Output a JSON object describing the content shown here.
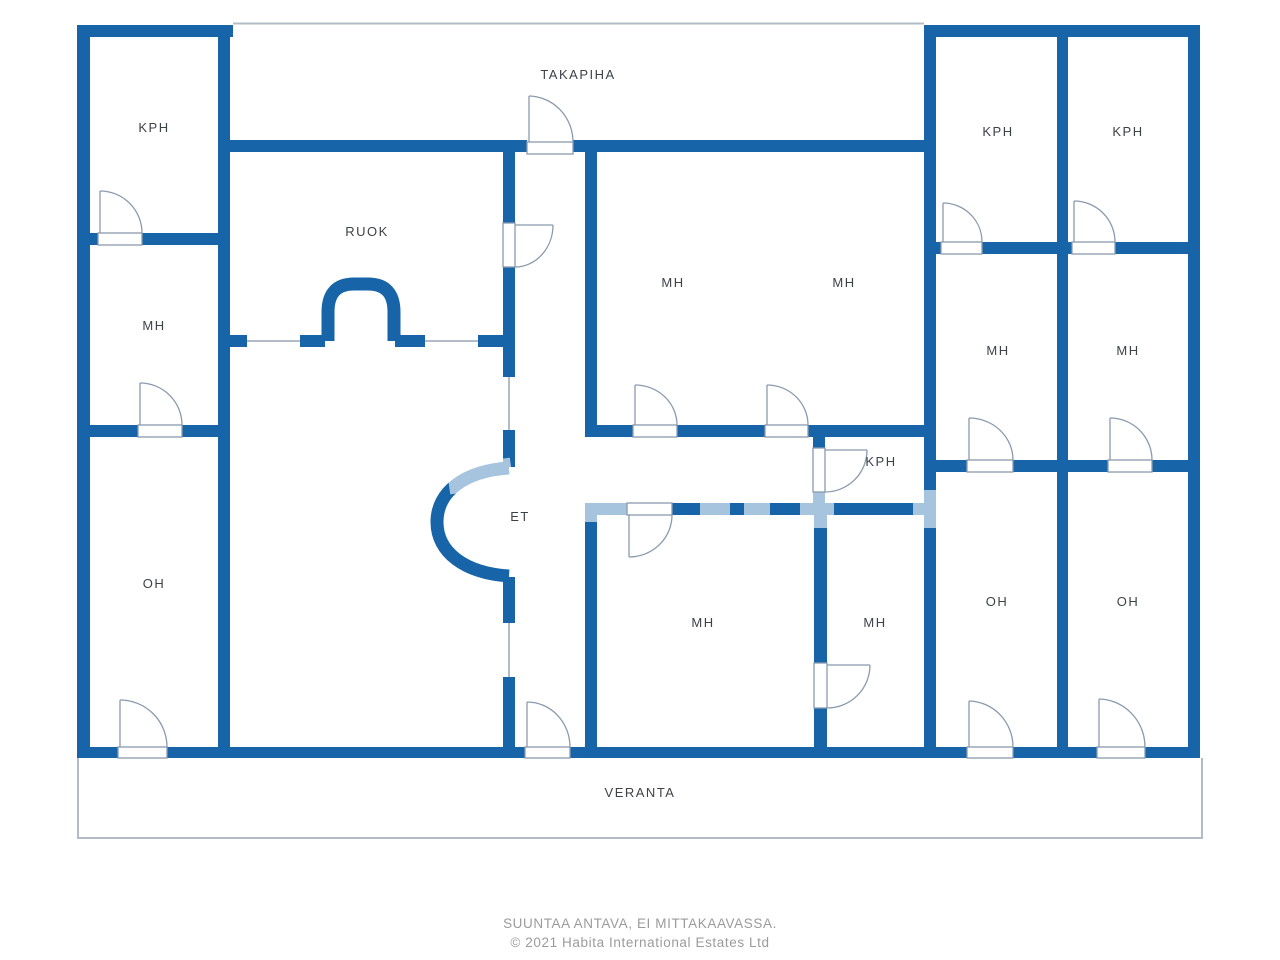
{
  "plan": {
    "rooms": {
      "kph_left": "KPH",
      "mh_left": "MH",
      "oh_left": "OH",
      "ruok": "RUOK",
      "et": "ET",
      "takapiha": "TAKAPIHA",
      "mh_top_1": "MH",
      "mh_top_2": "MH",
      "kph_small": "KPH",
      "mh_bottom_1": "MH",
      "mh_bottom_2": "MH",
      "kph_right_1": "KPH",
      "kph_right_2": "KPH",
      "mh_right_1": "MH",
      "mh_right_2": "MH",
      "oh_right_1": "OH",
      "oh_right_2": "OH",
      "veranta": "VERANTA"
    },
    "colors": {
      "wall": "#1765a8",
      "opening_line": "#b3bcc6",
      "door_line": "#8a9aae",
      "label": "#3d4247",
      "footer": "#9b9b9b"
    }
  },
  "footer": {
    "line1": "SUUNTAA ANTAVA, EI MITTAKAAVASSA.",
    "line2": "© 2021 Habita International Estates Ltd"
  }
}
